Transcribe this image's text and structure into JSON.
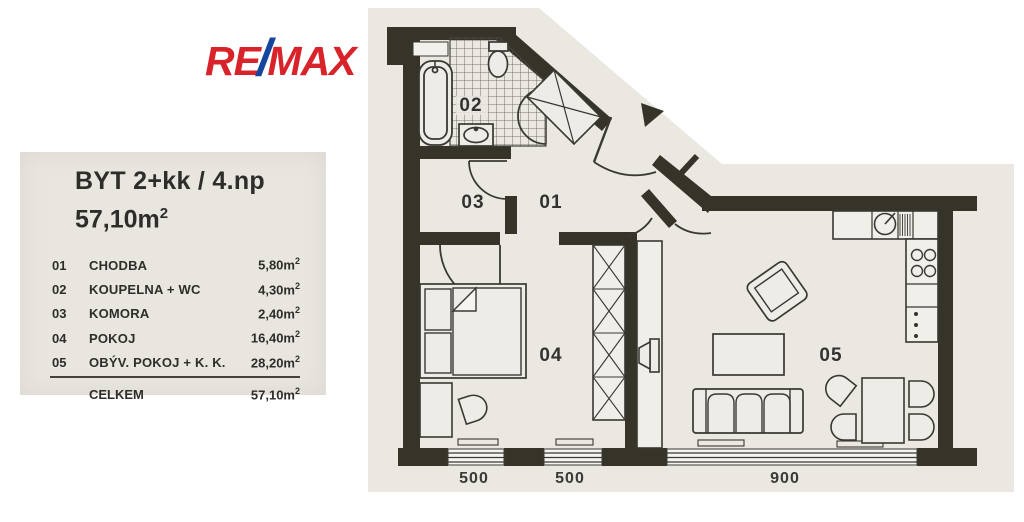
{
  "logo": {
    "re": "RE",
    "slash": "/",
    "max": "MAX"
  },
  "colors": {
    "logo_red": "#d9232a",
    "logo_blue": "#15459d",
    "paper": "#ebe8e2",
    "ink": "#363329"
  },
  "legend": {
    "title": "BYT 2+kk / 4.np",
    "total_area": "57,10m",
    "total_area_sup": "2",
    "rows": [
      {
        "num": "01",
        "name": "CHODBA",
        "area": "5,80m",
        "sup": "2"
      },
      {
        "num": "02",
        "name": "KOUPELNA + WC",
        "area": "4,30m",
        "sup": "2"
      },
      {
        "num": "03",
        "name": "KOMORA",
        "area": "2,40m",
        "sup": "2"
      },
      {
        "num": "04",
        "name": "POKOJ",
        "area": "16,40m",
        "sup": "2"
      },
      {
        "num": "05",
        "name": "OBÝV. POKOJ + K. K.",
        "area": "28,20m",
        "sup": "2"
      }
    ],
    "total": {
      "label": "CELKEM",
      "area": "57,10m",
      "sup": "2"
    }
  },
  "plan": {
    "room_labels": {
      "hallway": "01",
      "bathroom": "02",
      "storage": "03",
      "bedroom": "04",
      "living": "05"
    },
    "dimensions": [
      "500",
      "500",
      "900"
    ]
  }
}
